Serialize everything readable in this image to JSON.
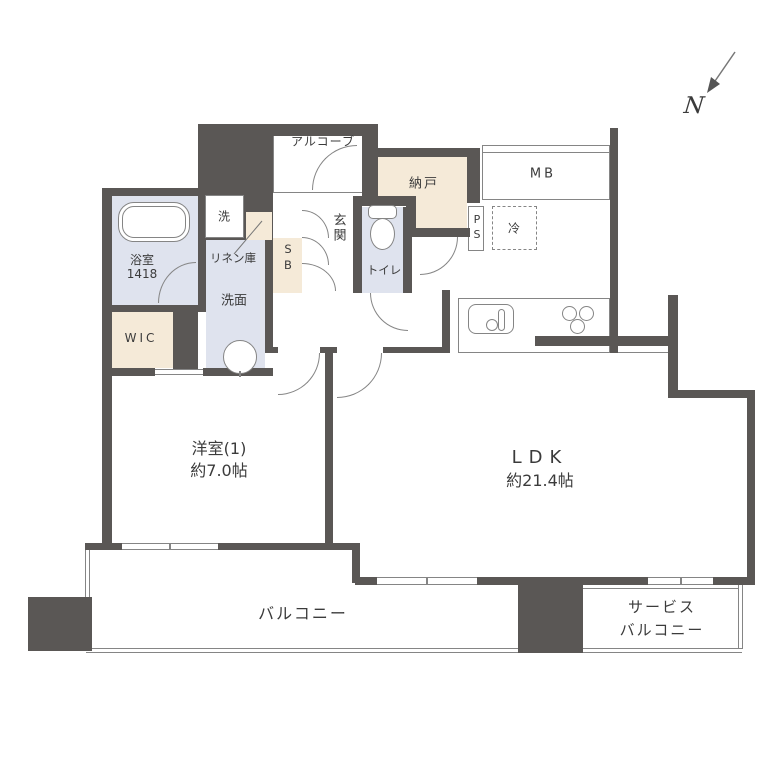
{
  "colors": {
    "wall": "#5a5755",
    "beige": "#f5ead8",
    "lavender": "#dfe3ee",
    "line": "#858585",
    "text": "#3b3b3b"
  },
  "compass": {
    "north_label": "N"
  },
  "rooms": {
    "alcove": {
      "label": "アルコーブ"
    },
    "entrance": {
      "label": "玄関"
    },
    "shoe_box": {
      "label": "SB"
    },
    "storage": {
      "label": "納戸"
    },
    "meter_box": {
      "label": "MB"
    },
    "pipe_space": {
      "label": "PS"
    },
    "refrigerator": {
      "label": "冷"
    },
    "toilet": {
      "label": "トイレ"
    },
    "washer": {
      "label": "洗"
    },
    "linen_closet": {
      "label": "リネン庫"
    },
    "washroom": {
      "label": "洗面"
    },
    "bathroom": {
      "label": "浴室",
      "size": "1418"
    },
    "walk_in_closet": {
      "label": "WIC"
    },
    "bedroom": {
      "label": "洋室(1)",
      "area": "約7.0帖"
    },
    "ldk": {
      "label": "LDK",
      "area": "約21.4帖"
    },
    "balcony": {
      "label": "バルコニー"
    },
    "service_balcony": {
      "label_line1": "サービス",
      "label_line2": "バルコニー"
    }
  }
}
